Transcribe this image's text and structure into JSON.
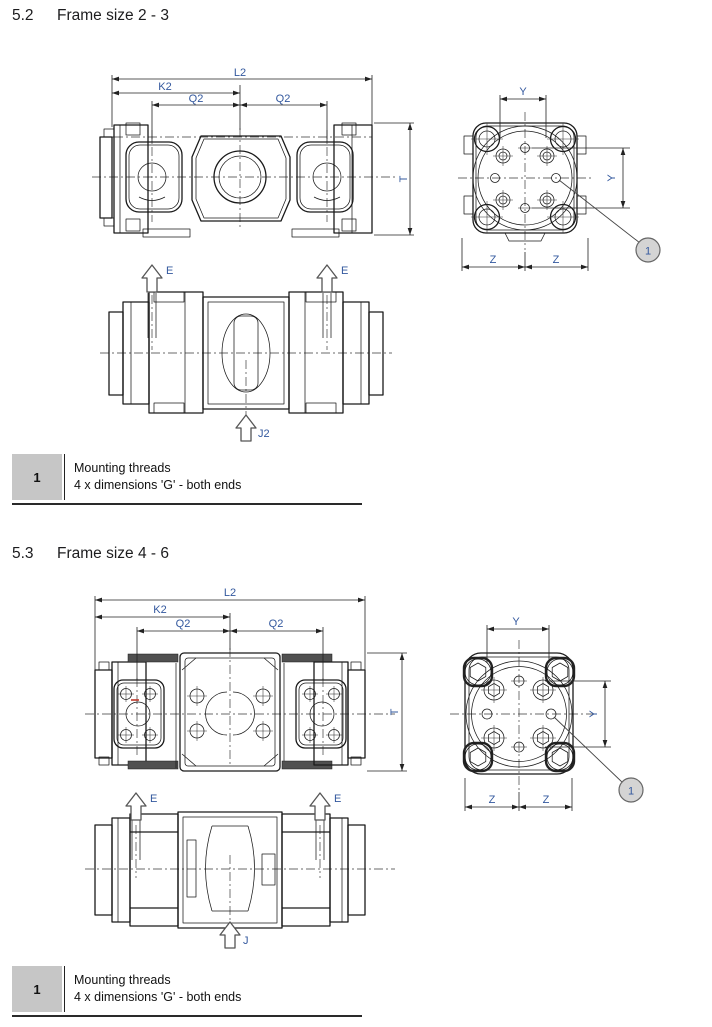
{
  "page": {
    "background": "#ffffff"
  },
  "colors": {
    "label_blue": "#33589e",
    "line": "#1a1a1a",
    "legend_key_bg": "#c6c6c6",
    "callout_fill": "#d4d4d4",
    "annotation_red": "#c0392b"
  },
  "sections": {
    "s52": {
      "heading": {
        "number": "5.2",
        "title": "Frame size 2 - 3"
      },
      "front_view": {
        "dim_l2": "L2",
        "dim_k2": "K2",
        "dim_q2_left": "Q2",
        "dim_q2_right": "Q2",
        "dim_t": "T"
      },
      "side_view": {
        "port_e_left": "E",
        "port_e_right": "E",
        "port_j": "J2"
      },
      "end_view": {
        "dim_y_top": "Y",
        "dim_y_side": "Y",
        "dim_z_left": "Z",
        "dim_z_right": "Z",
        "callout": "1"
      },
      "legend": {
        "key": "1",
        "line1": "Mounting threads",
        "line2": "4 x dimensions 'G' - both ends"
      }
    },
    "s53": {
      "heading": {
        "number": "5.3",
        "title": "Frame size 4 - 6"
      },
      "front_view": {
        "dim_l2": "L2",
        "dim_k2": "K2",
        "dim_q2_left": "Q2",
        "dim_q2_right": "Q2",
        "dim_t": "T"
      },
      "side_view": {
        "port_e_left": "E",
        "port_e_right": "E",
        "port_j": "J"
      },
      "end_view": {
        "dim_y_top": "Y",
        "dim_y_side": "Y",
        "dim_z_left": "Z",
        "dim_z_right": "Z",
        "callout": "1"
      },
      "legend": {
        "key": "1",
        "line1": "Mounting threads",
        "line2": "4 x dimensions 'G' - both ends"
      }
    }
  }
}
